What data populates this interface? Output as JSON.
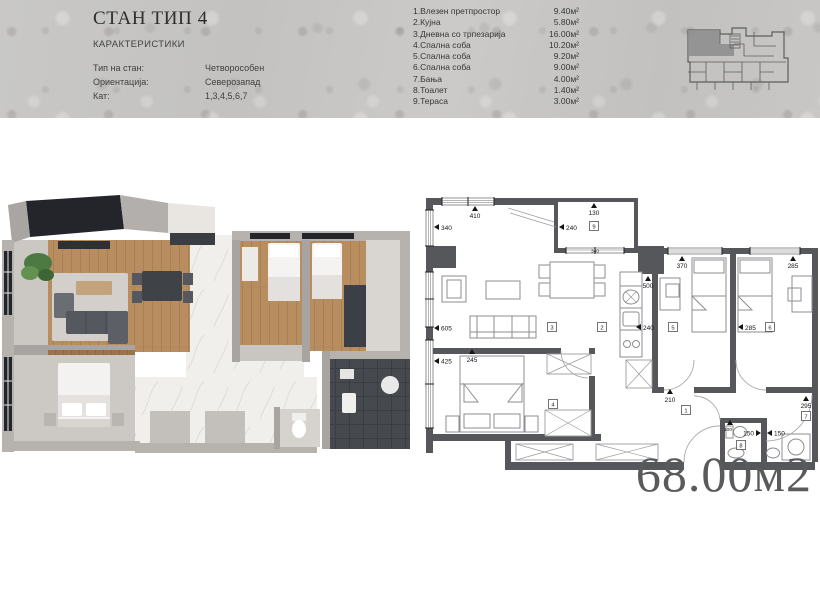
{
  "header": {
    "title": "СТАН ТИП 4",
    "subtitle": "КАРАКТЕРИСТИКИ",
    "specs": [
      {
        "label": "Тип на стан:",
        "value": "Четворособен"
      },
      {
        "label": "Ориентација:",
        "value": "Северозапад"
      },
      {
        "label": "Кат:",
        "value": "1,3,4,5,6,7"
      }
    ],
    "room_list": [
      {
        "name": "1.Влезен претпростор",
        "area": "9.40м²"
      },
      {
        "name": "2.Кујна",
        "area": "5.80м²"
      },
      {
        "name": "3.Дневна со трпезарија",
        "area": "16.00м²"
      },
      {
        "name": "4.Спална соба",
        "area": "10.20м²"
      },
      {
        "name": "5.Спална соба",
        "area": "9.20м²"
      },
      {
        "name": "6.Спална соба",
        "area": "9.00м²"
      },
      {
        "name": "7.Бања",
        "area": "4.00м²"
      },
      {
        "name": "8.Тоалет",
        "area": "1.40м²"
      },
      {
        "name": "9.Тераса",
        "area": "3.00м²"
      }
    ],
    "site_plan_icon": "building-location-plan"
  },
  "plan2d": {
    "total_area": "68.00м2",
    "dims": {
      "living_window": "410",
      "terrace_depth": "130",
      "left_window_top": "340",
      "terrace_left": "240",
      "terrace_window": "340",
      "left_window_mid": "605",
      "left_window_bottom": "425",
      "bedroom4_top": "245",
      "kitchen_height": "500",
      "bedroom5_window": "370",
      "bedroom6_window": "285",
      "kitchen_wall": "240",
      "bedroom_divider": "285",
      "hall_width": "210",
      "bath_width": "295",
      "toilet_width": "100",
      "toilet_wall_left": "150",
      "toilet_wall_right": "150"
    },
    "rooms": {
      "r1": "1",
      "r2": "2",
      "r3": "3",
      "r4": "4",
      "r5": "5",
      "r6": "6",
      "r7": "7",
      "r8": "8",
      "r9": "9"
    }
  },
  "colors": {
    "wall": "#56575a",
    "wood": "#b88e61",
    "area_text": "#595a5c"
  }
}
